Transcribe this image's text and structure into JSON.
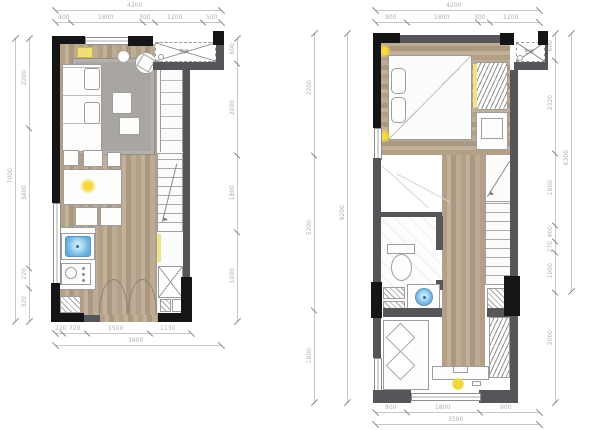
{
  "colors": {
    "background": "#ffffff",
    "wall_gray": "#55555a",
    "wall_black": "#151517",
    "floor_wood": "#b8a68f",
    "rug_gray": "#a9a6a1",
    "accent_light_yellow": "#f0d73c",
    "sink_blue": "#6fb6e4",
    "dimension_text": "#b3b1ae"
  },
  "icons": {
    "ceiling_light": "sun-glow",
    "ac_unit": "dashed-box-x-cross",
    "stairs": "stepped-lines-with-arrow",
    "double_door": "twin-swing-arcs",
    "wardrobe": "diagonal-hatch"
  },
  "left_plan": {
    "title": "first-floor-plan",
    "ac_label": "空调",
    "dims": {
      "top_total": "4200",
      "top_segments": [
        "400",
        "1800",
        "300",
        "1200",
        "500"
      ],
      "left_total": "7000",
      "left_segments": [
        "2200",
        "3400",
        "220",
        "320"
      ],
      "right_segments": [
        "600",
        "2000",
        "1800",
        "1000"
      ],
      "bottom_segments": [
        "220",
        "720",
        "1500",
        "1130"
      ],
      "bottom_total": "3800"
    }
  },
  "right_plan": {
    "title": "second-floor-plan",
    "ac_label": "空调",
    "dims": {
      "top_total": "4200",
      "top_segments": [
        "800",
        "1800",
        "300",
        "1200"
      ],
      "left_total": "9200",
      "left_segments": [
        "2200",
        "5200",
        "1800"
      ],
      "right_total": "6300",
      "right_segments": [
        "600",
        "2320",
        "1800",
        "400",
        "270",
        "1000",
        "2000"
      ],
      "bottom_segments": [
        "800",
        "1800",
        "900"
      ],
      "bottom_total": "3500"
    }
  }
}
